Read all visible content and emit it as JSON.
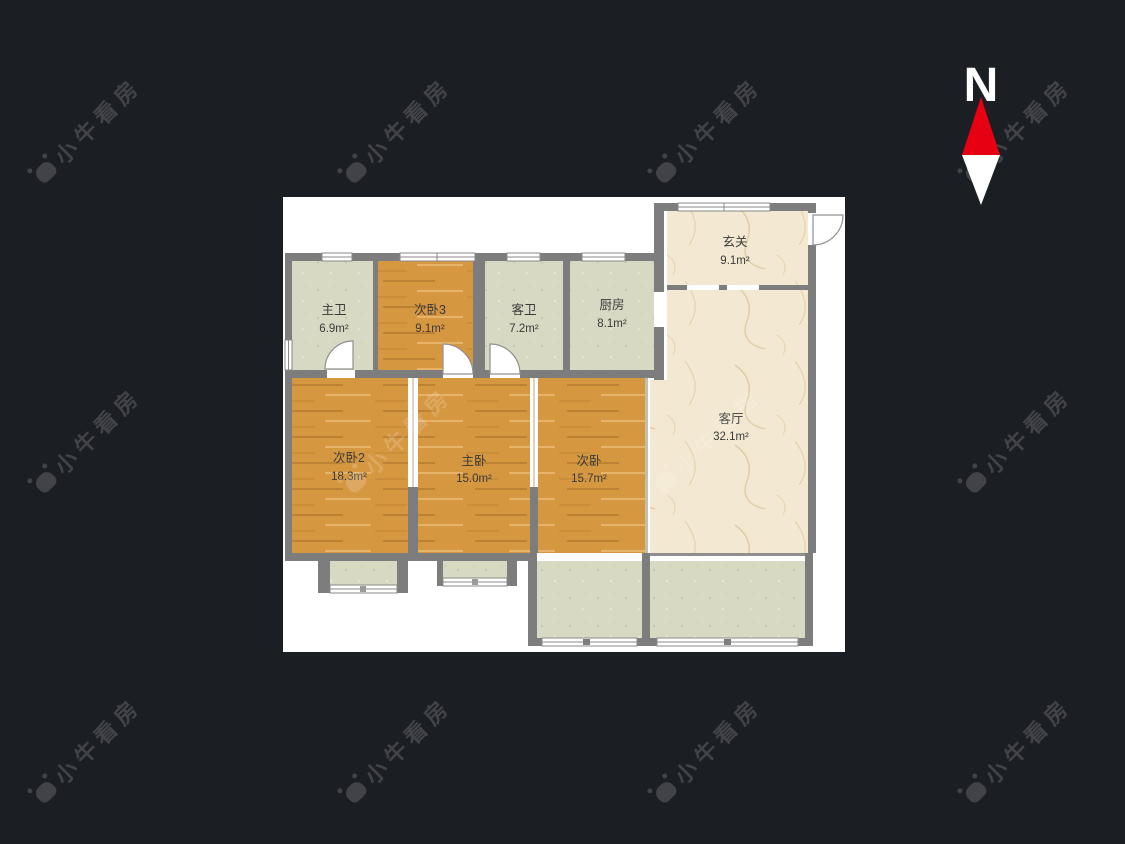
{
  "scene": {
    "type": "residential-floor-plan"
  },
  "compass": {
    "label": "N"
  },
  "watermark": {
    "text": "小牛看房"
  },
  "colors": {
    "background": "#1b1e23",
    "canvas": "#ffffff",
    "wall": "#7d7d7d",
    "wood_floor": "#d69741",
    "tile_floor": "#d7d9c3",
    "marble_floor": "#f3e8d1",
    "compass_red": "#e60012",
    "label_text": "#3a3a3a"
  },
  "rooms": [
    {
      "id": "master-bath",
      "name": "主卫",
      "area": "6.9m²"
    },
    {
      "id": "bedroom-3",
      "name": "次卧3",
      "area": "9.1m²"
    },
    {
      "id": "guest-bath",
      "name": "客卫",
      "area": "7.2m²"
    },
    {
      "id": "kitchen",
      "name": "厨房",
      "area": "8.1m²"
    },
    {
      "id": "entry-hall",
      "name": "玄关",
      "area": "9.1m²"
    },
    {
      "id": "living-room",
      "name": "客厅",
      "area": "32.1m²"
    },
    {
      "id": "bedroom-2",
      "name": "次卧2",
      "area": "18.3m²"
    },
    {
      "id": "master-bedroom",
      "name": "主卧",
      "area": "15.0m²"
    },
    {
      "id": "bedroom",
      "name": "次卧",
      "area": "15.7m²"
    }
  ]
}
